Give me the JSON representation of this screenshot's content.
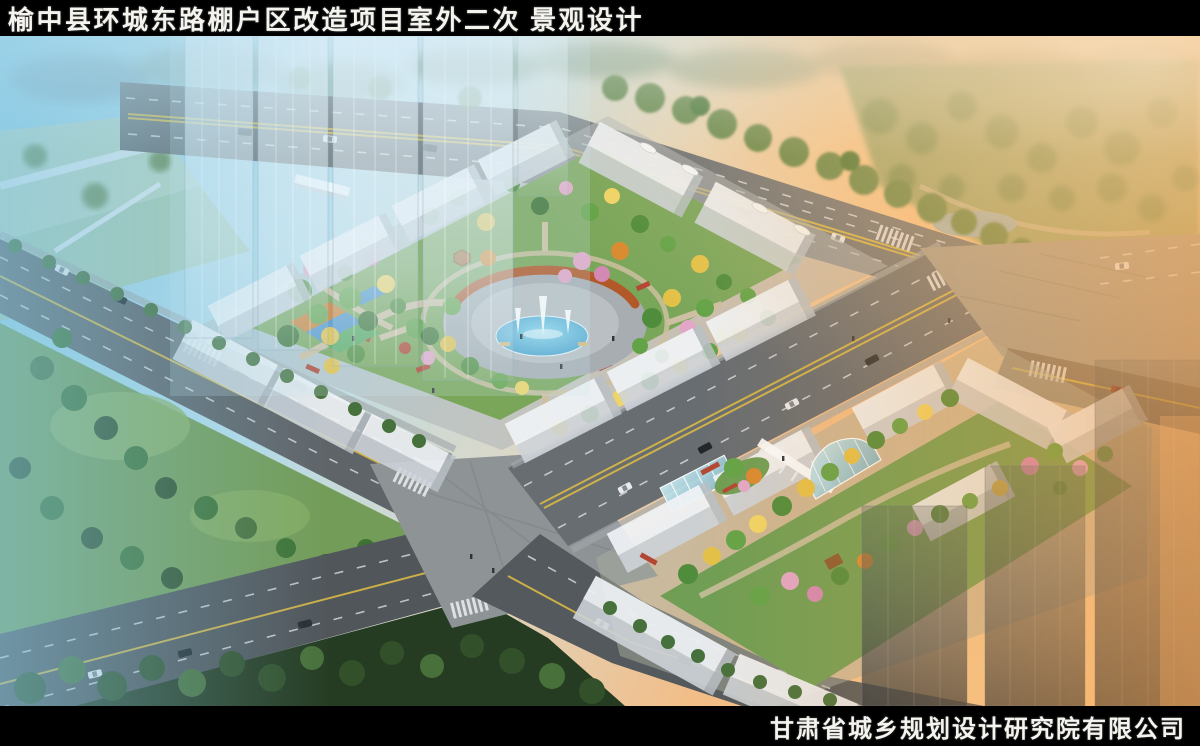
{
  "header": {
    "title": "榆中县环城东路棚户区改造项目室外二次 景观设计"
  },
  "footer": {
    "company": "甘肃省城乡规划设计研究院有限公司"
  },
  "palette": {
    "bar_bg": "#000000",
    "bar_text": "#f4f3ee",
    "sky_blue": "#8ecbe2",
    "sunset_orange": "#f4a24e",
    "asphalt": "#5f6468",
    "lane_yellow": "#d9b945",
    "lane_white": "#e9ecee",
    "building_white": "#eef1f4",
    "courtyard_green": "#7aa65a",
    "tree_green": "#4f8c3c",
    "tree_yellow": "#e3c148",
    "tree_pink": "#e3a6c6",
    "pergola_rust": "#b2592a",
    "pool_blue": "#4aa3cf",
    "dark_park": "#263c22"
  }
}
